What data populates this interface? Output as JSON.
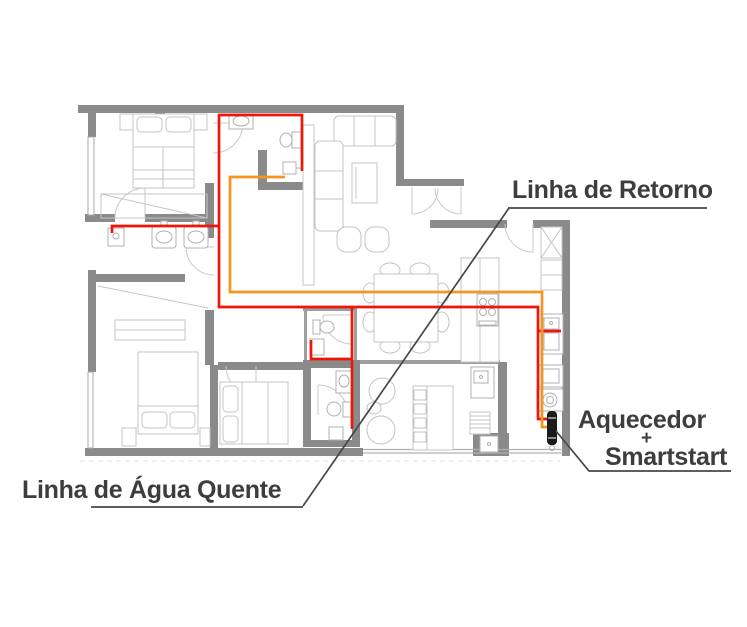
{
  "annotations": {
    "return_line": "Linha de Retorno",
    "hot_water_line": "Linha de Água Quente",
    "heater_label_top": "Aquecedor",
    "heater_label_plus": "+",
    "heater_label_bottom": "Smartstart"
  },
  "colors": {
    "hot_water_pipe": "#ee1509",
    "return_pipe": "#f79421",
    "wall": "#8a8a8a",
    "furniture_line": "#c4c4c4",
    "label_text": "#3d3d3d",
    "leader_line": "#474747",
    "heater_body": "#1c1c1c"
  },
  "pipes": {
    "hot_water": {
      "name": "Linha de Água Quente",
      "color": "#ee1509",
      "paths": [
        [
          [
            551,
            419
          ],
          [
            538,
            419
          ],
          [
            538,
            307
          ],
          [
            219,
            307
          ],
          [
            219,
            115
          ],
          [
            302,
            115
          ],
          [
            302,
            171
          ]
        ],
        [
          [
            219,
            226
          ],
          [
            112,
            226
          ],
          [
            112,
            233
          ]
        ],
        [
          [
            352,
            307
          ],
          [
            352,
            429
          ]
        ],
        [
          [
            352,
            359
          ],
          [
            311,
            359
          ],
          [
            311,
            340
          ]
        ],
        [
          [
            538,
            331
          ],
          [
            561,
            331
          ]
        ]
      ]
    },
    "return": {
      "name": "Linha de Retorno",
      "color": "#f79421",
      "paths": [
        [
          [
            285,
            177
          ],
          [
            230,
            177
          ],
          [
            230,
            292
          ],
          [
            542,
            292
          ],
          [
            542,
            427
          ],
          [
            551,
            427
          ]
        ]
      ]
    }
  },
  "leaders": {
    "main_diagonal": [
      [
        509,
        208
      ],
      [
        303,
        506
      ]
    ],
    "return_underline": [
      [
        508,
        208
      ],
      [
        707,
        208
      ]
    ],
    "hot_water_underline": [
      [
        91,
        507
      ],
      [
        303,
        507
      ]
    ],
    "heater_leader": [
      [
        556,
        431
      ],
      [
        589,
        471
      ],
      [
        731,
        471
      ]
    ]
  }
}
